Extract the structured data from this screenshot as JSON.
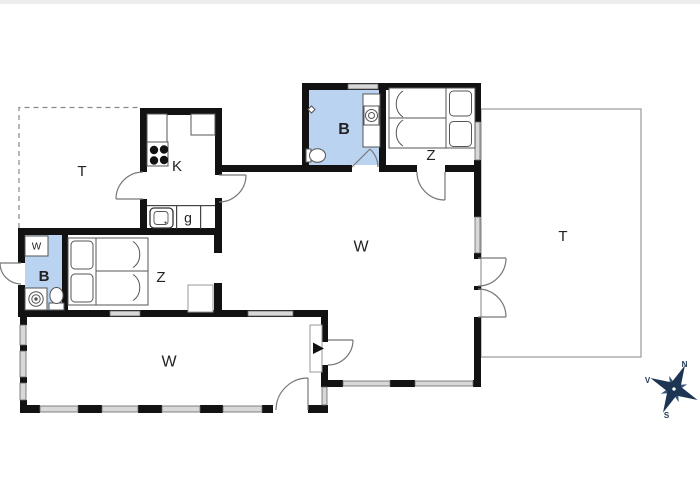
{
  "plan": {
    "type": "holiday-house-floor-plan"
  },
  "rooms": {
    "terrace_left": {
      "label": "T"
    },
    "kitchen": {
      "label": "K"
    },
    "hallway": {
      "label": "g"
    },
    "bathroom_top": {
      "label": "B"
    },
    "bedroom_top": {
      "label": "Z"
    },
    "living_room": {
      "label": "W"
    },
    "terrace_right": {
      "label": "T"
    },
    "bathroom_annex": {
      "label": "B"
    },
    "wardrobe": {
      "label": "W"
    },
    "bedroom_left": {
      "label": "Z"
    },
    "living_room_wing": {
      "label": "W"
    }
  },
  "compass": {
    "north_label": "N",
    "west_label": "V",
    "south_label": "S"
  },
  "colors": {
    "wall": "#121212",
    "bathroom_fill": "#b9d3f0",
    "bathroom_label": "#1c3e6e",
    "window_fill": "#d8d8d8",
    "terrace_outline": "#9a9a9a",
    "dashed_outline": "#888888",
    "door_swing": "#777777",
    "furniture_outline": "#555555",
    "compass_primary": "#1d3553",
    "compass_secondary": "#35567a",
    "label_color": "#222222"
  }
}
